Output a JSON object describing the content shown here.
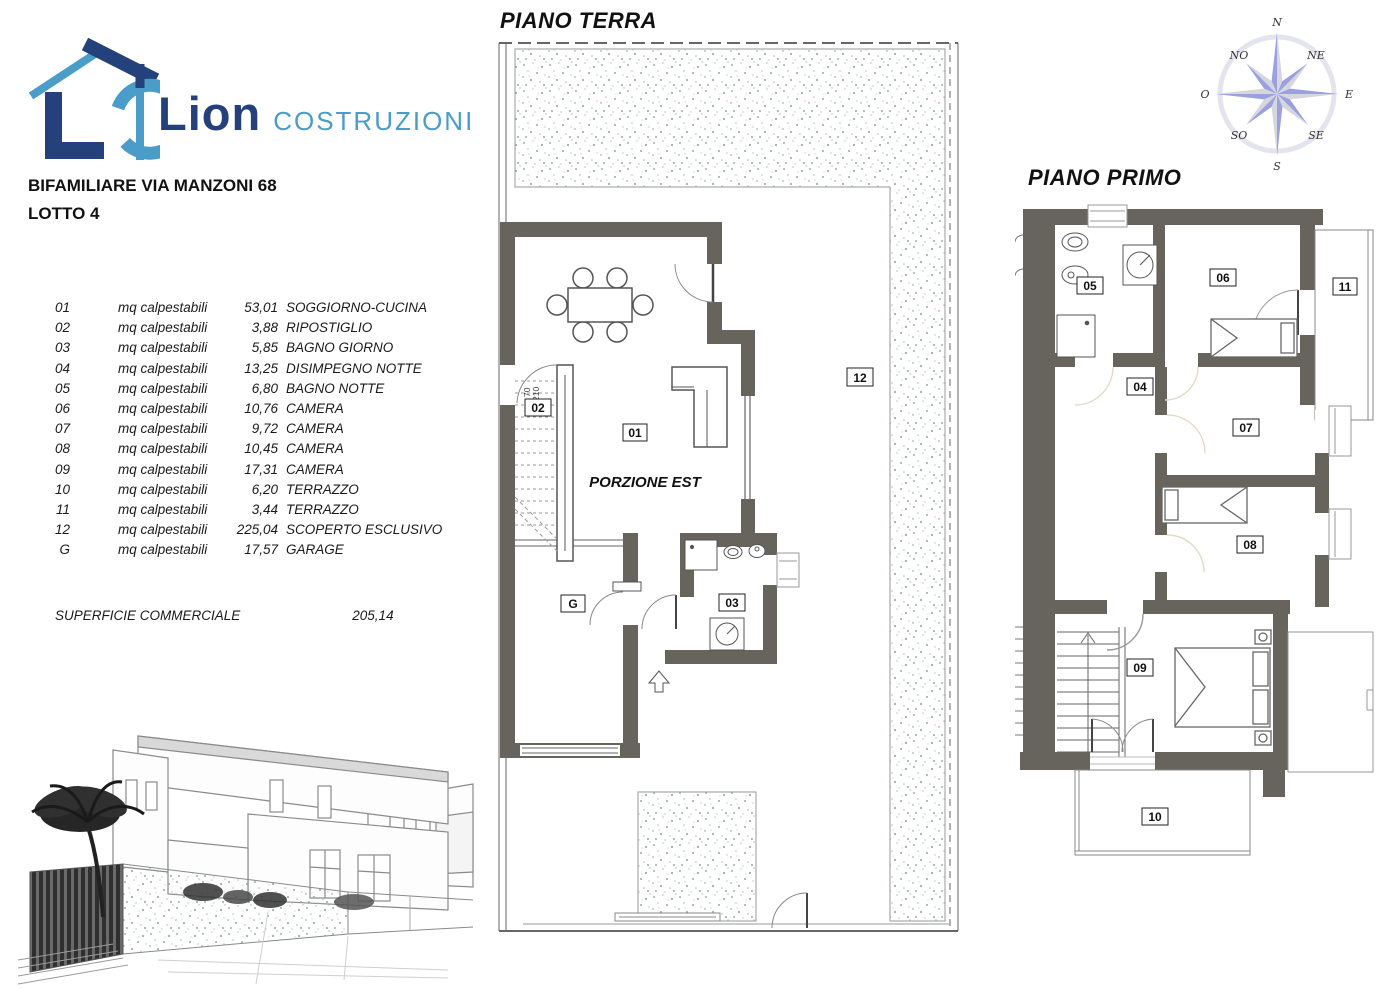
{
  "brand": {
    "name": "Lion",
    "suffix": "COSTRUZIONI",
    "navy": "#24417C",
    "light_blue": "#4A9CC9"
  },
  "project": {
    "title": "BIFAMILIARE VIA MANZONI 68",
    "lot": "LOTTO 4"
  },
  "areas": {
    "rows": [
      {
        "code": "01",
        "unit": "mq calpestabili",
        "value": "53,01",
        "room": "SOGGIORNO-CUCINA"
      },
      {
        "code": "02",
        "unit": "mq calpestabili",
        "value": "3,88",
        "room": "RIPOSTIGLIO"
      },
      {
        "code": "03",
        "unit": "mq calpestabili",
        "value": "5,85",
        "room": "BAGNO GIORNO"
      },
      {
        "code": "04",
        "unit": "mq calpestabili",
        "value": "13,25",
        "room": "DISIMPEGNO NOTTE"
      },
      {
        "code": "05",
        "unit": "mq calpestabili",
        "value": "6,80",
        "room": "BAGNO NOTTE"
      },
      {
        "code": "06",
        "unit": "mq calpestabili",
        "value": "10,76",
        "room": "CAMERA"
      },
      {
        "code": "07",
        "unit": "mq calpestabili",
        "value": "9,72",
        "room": "CAMERA"
      },
      {
        "code": "08",
        "unit": "mq calpestabili",
        "value": "10,45",
        "room": "CAMERA"
      },
      {
        "code": "09",
        "unit": "mq calpestabili",
        "value": "17,31",
        "room": "CAMERA"
      },
      {
        "code": "10",
        "unit": "mq calpestabili",
        "value": "6,20",
        "room": "TERRAZZO"
      },
      {
        "code": "11",
        "unit": "mq calpestabili",
        "value": "3,44",
        "room": "TERRAZZO"
      },
      {
        "code": "12",
        "unit": "mq calpestabili",
        "value": "225,04",
        "room": "SCOPERTO ESCLUSIVO"
      },
      {
        "code": "G",
        "unit": "mq calpestabili",
        "value": "17,57",
        "room": "GARAGE"
      }
    ],
    "summary": {
      "label": "SUPERFICIE COMMERCIALE",
      "value": "205,14"
    }
  },
  "ground_floor": {
    "title": "PIANO TERRA",
    "portion": "PORZIONE EST",
    "door_width": "70",
    "door_height": "210",
    "labels": {
      "r01": "01",
      "r02": "02",
      "r03": "03",
      "r12": "12",
      "garage": "G"
    }
  },
  "first_floor": {
    "title": "PIANO PRIMO",
    "labels": {
      "r04": "04",
      "r05": "05",
      "r06": "06",
      "r07": "07",
      "r08": "08",
      "r09": "09",
      "r10": "10",
      "r11": "11"
    }
  },
  "compass": {
    "n": "N",
    "ne": "NE",
    "e": "E",
    "se": "SE",
    "s": "S",
    "so": "SO",
    "o": "O",
    "no": "NO"
  },
  "colors": {
    "wall": "#66645C",
    "navy": "#24417C",
    "light_blue": "#4A9CC9",
    "compass_purple": "#9BA0DF",
    "compass_gray": "#D6D6DE"
  }
}
